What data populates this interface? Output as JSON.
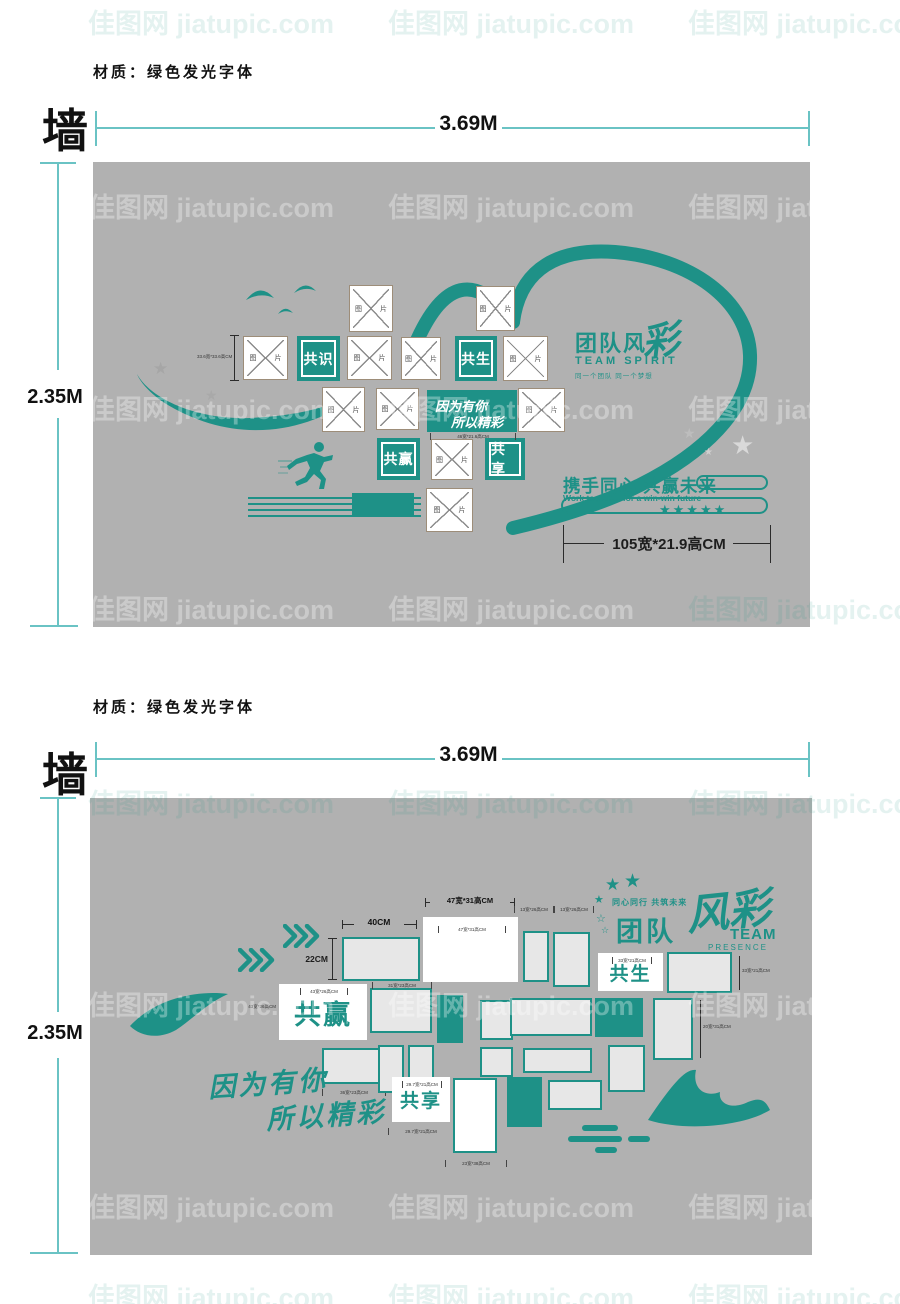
{
  "watermark": {
    "text": "佳图网 jiatupic.com"
  },
  "icons": {
    "star": "★",
    "star_outline": "☆"
  },
  "colors": {
    "teal": "#1e9187",
    "panel_gray": "#b1b1b1",
    "dim_line": "#6ac3c4"
  },
  "section1": {
    "material_note": "材质：绿色发光字体",
    "wall_label": "墙",
    "width_dim": "3.69M",
    "height_dim": "2.35M",
    "frame_label": "图 片",
    "side_dim": "33.6宽*33.6高CM",
    "keywords": {
      "k1": "共识",
      "k2": "共生",
      "k3": "共赢",
      "k4": "共享"
    },
    "slogan": {
      "l1": "因为有你",
      "l2": "所以精彩",
      "dim": "46宽*21.6高CM"
    },
    "logo": {
      "cn": "团队风",
      "cai": "彩",
      "en": "TEAM SPIRIT",
      "sub": "同一个团队 同一个梦想"
    },
    "footer": {
      "cn": "携手同心 共赢未来",
      "en": "Work together for a win-win future",
      "stars": "★★★★★"
    },
    "bottom_dim": "105宽*21.9高CM"
  },
  "section2": {
    "material_note": "材质：绿色发光字体",
    "wall_label": "墙",
    "width_dim": "3.69M",
    "height_dim": "2.35M",
    "keywords": {
      "sheng": "共生",
      "ying": "共赢",
      "xiang": "共享"
    },
    "script": {
      "l1": "因为有你",
      "l2": "所以精彩"
    },
    "logo": {
      "tagline": "同心同行 共筑未来",
      "cn": "团队",
      "cai": "风彩",
      "en": "TEAM",
      "en2": "PRESENCE"
    },
    "dims": {
      "d40": "40CM",
      "d22": "22CM",
      "d47": "47宽*31高CM",
      "d43": "43宽*26高CM",
      "d36": "36宽*23高CM",
      "d297": "29.7宽*21高CM",
      "d13": "13宽*26高CM",
      "d33": "33宽*21高CM",
      "d20": "20宽*31高CM",
      "d23": "23宽*38高CM",
      "d31": "31宽*23高CM"
    }
  }
}
